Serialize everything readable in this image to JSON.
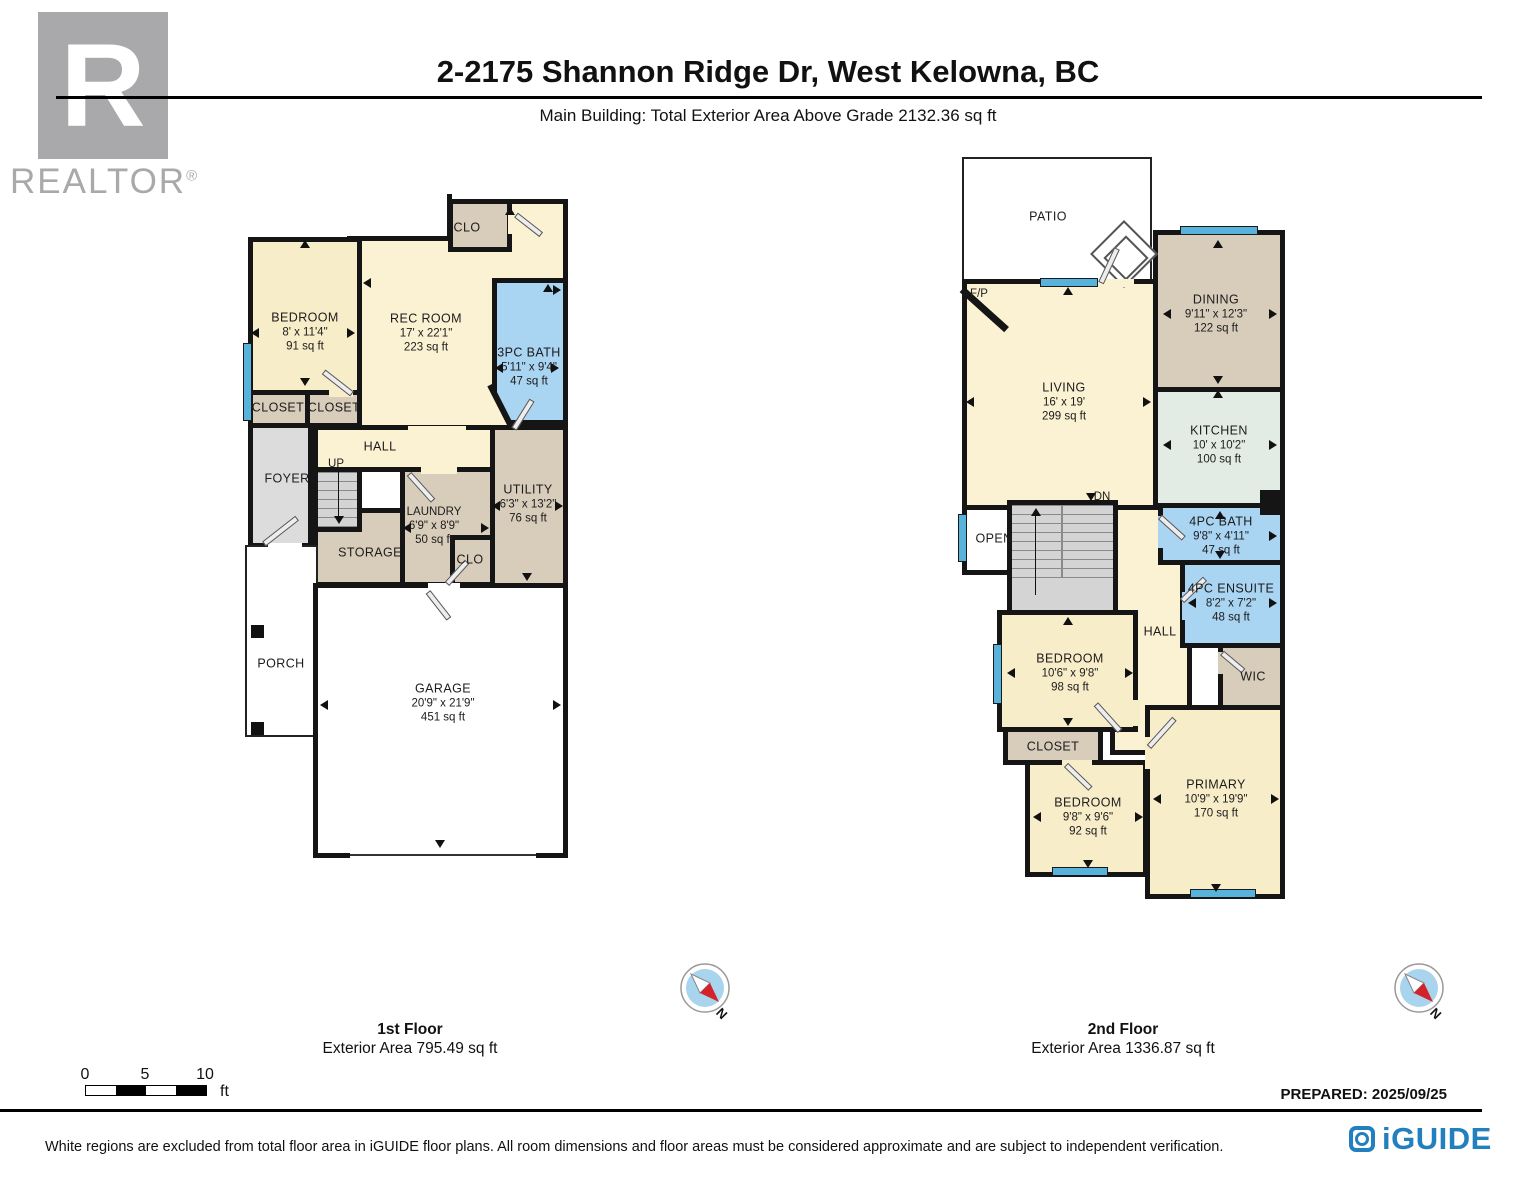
{
  "header": {
    "title": "2-2175 Shannon Ridge Dr, West Kelowna, BC",
    "subtitle": "Main Building: Total Exterior Area Above Grade 2132.36 sq ft",
    "realtor_logo": {
      "letter": "R",
      "wordmark": "REALTOR",
      "registered": "®"
    }
  },
  "floors": [
    {
      "name": "1st Floor",
      "area_label": "Exterior Area 795.49 sq ft",
      "rooms": [
        {
          "label": "CLO"
        },
        {
          "label": "BEDROOM",
          "dims": "8' x 11'4\"",
          "area": "91 sq ft"
        },
        {
          "label": "REC ROOM",
          "dims": "17' x 22'1\"",
          "area": "223 sq ft"
        },
        {
          "label": "3PC BATH",
          "dims": "5'11\" x 9'4\"",
          "area": "47 sq ft"
        },
        {
          "label": "CLOSET"
        },
        {
          "label": "CLOSET"
        },
        {
          "label": "FOYER"
        },
        {
          "label": "HALL"
        },
        {
          "label": "UP"
        },
        {
          "label": "STORAGE"
        },
        {
          "label": "LAUNDRY",
          "dims": "6'9\" x 8'9\"",
          "area": "50 sq ft"
        },
        {
          "label": "CLO"
        },
        {
          "label": "UTILITY",
          "dims": "6'3\" x 13'2\"",
          "area": "76 sq ft"
        },
        {
          "label": "PORCH"
        },
        {
          "label": "GARAGE",
          "dims": "20'9\" x 21'9\"",
          "area": "451 sq ft"
        }
      ]
    },
    {
      "name": "2nd Floor",
      "area_label": "Exterior Area 1336.87 sq ft",
      "rooms": [
        {
          "label": "PATIO"
        },
        {
          "label": "F/P"
        },
        {
          "label": "LIVING",
          "dims": "16' x 19'",
          "area": "299 sq ft"
        },
        {
          "label": "DINING",
          "dims": "9'11\" x 12'3\"",
          "area": "122 sq ft"
        },
        {
          "label": "KITCHEN",
          "dims": "10' x 10'2\"",
          "area": "100 sq ft"
        },
        {
          "label": "4PC BATH",
          "dims": "9'8\" x 4'11\"",
          "area": "47 sq ft"
        },
        {
          "label": "4PC ENSUITE",
          "dims": "8'2\" x 7'2\"",
          "area": "48 sq ft"
        },
        {
          "label": "OPEN"
        },
        {
          "label": "DN"
        },
        {
          "label": "HALL"
        },
        {
          "label": "WIC"
        },
        {
          "label": "BEDROOM",
          "dims": "10'6\" x 9'8\"",
          "area": "98 sq ft"
        },
        {
          "label": "CLOSET"
        },
        {
          "label": "BEDROOM",
          "dims": "9'8\" x 9'6\"",
          "area": "92 sq ft"
        },
        {
          "label": "PRIMARY",
          "dims": "10'9\" x 19'9\"",
          "area": "170 sq ft"
        }
      ]
    }
  ],
  "compass": {
    "north": "N"
  },
  "scale_bar": {
    "ticks": [
      "0",
      "5",
      "10"
    ],
    "unit": "ft"
  },
  "footer": {
    "prepared": "PREPARED: 2025/09/25",
    "disclaimer": "White regions are excluded from total floor area in iGUIDE floor plans. All room dimensions and floor areas must be considered approximate and are subject to independent verification.",
    "brand": "iGUIDE"
  },
  "colors": {
    "wall": "#151515",
    "cream": "#FBF2D3",
    "tan": "#D8CCBA",
    "bath_blue": "#A9D4F2",
    "kitchen_green": "#E3ECE4",
    "room_gray": "#DCDCDC",
    "window_blue": "#57B2DC",
    "iguide_blue": "#2380BE",
    "compass_blue": "#A9D4EE",
    "compass_red": "#D2222A",
    "realtor_gray": "#A9A9AC"
  }
}
